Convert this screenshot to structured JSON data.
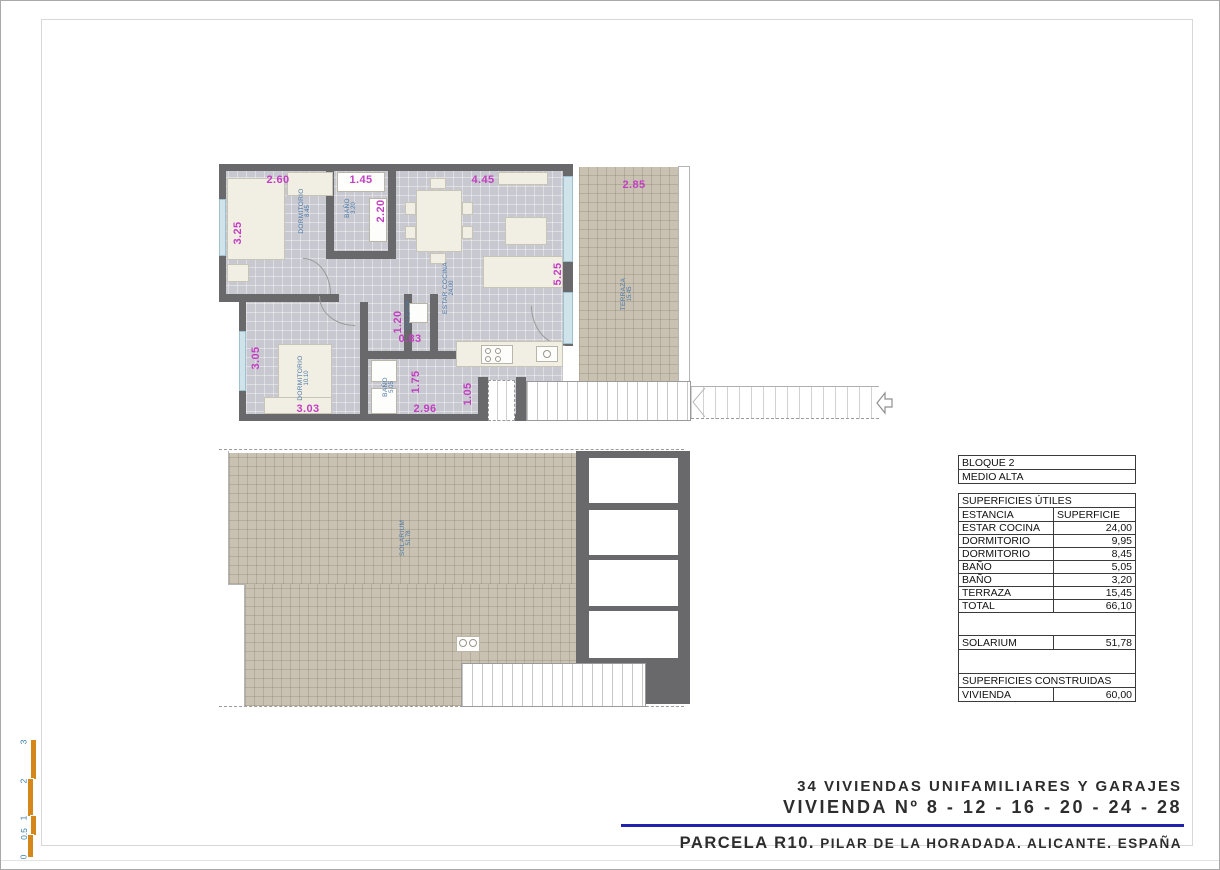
{
  "title_block": {
    "line1": "34 VIVIENDAS UNIFAMILIARES Y GARAJES",
    "line2": "VIVIENDA Nº 8 - 12 - 16 - 20 - 24 - 28",
    "line3_lead": "PARCELA R10.",
    "line3_rest": " PILAR DE LA HORADADA. ALICANTE. ESPAÑA"
  },
  "table": {
    "block": "BLOQUE 2",
    "level": "MEDIO ALTA",
    "section_utiles": "SUPERFICIES ÚTILES",
    "col_room": "ESTANCIA",
    "col_area": "SUPERFICIE",
    "rows": [
      {
        "room": "ESTAR COCINA",
        "area": "24,00"
      },
      {
        "room": "DORMITORIO",
        "area": "9,95"
      },
      {
        "room": "DORMITORIO",
        "area": "8,45"
      },
      {
        "room": "BAÑO",
        "area": "5,05"
      },
      {
        "room": "BAÑO",
        "area": "3,20"
      },
      {
        "room": "TERRAZA",
        "area": "15,45"
      },
      {
        "room": "TOTAL",
        "area": "66,10"
      }
    ],
    "solarium": {
      "room": "SOLARIUM",
      "area": "51,78"
    },
    "section_construidas": "SUPERFICIES CONSTRUIDAS",
    "vivienda": {
      "room": "VIVIENDA",
      "area": "60,00"
    }
  },
  "plan_upper": {
    "rooms": [
      {
        "name": "DORMITORIO",
        "area": "8.45",
        "x": 304,
        "y": 210
      },
      {
        "name": "BAÑO",
        "area": "3.20",
        "x": 350,
        "y": 207
      },
      {
        "name": "ESTAR COCINA",
        "area": "24.00",
        "x": 448,
        "y": 287
      },
      {
        "name": "TERRAZA",
        "area": "15.45",
        "x": 626,
        "y": 293
      },
      {
        "name": "GALERIA",
        "area": "",
        "x": 407,
        "y": 314
      },
      {
        "name": "DORMITORIO",
        "area": "10.10",
        "x": 303,
        "y": 377
      },
      {
        "name": "BAÑO",
        "area": "5.05",
        "x": 388,
        "y": 386
      }
    ],
    "dimensions": [
      {
        "text": "2.60",
        "x": 277,
        "y": 179,
        "rot": 0
      },
      {
        "text": "1.45",
        "x": 360,
        "y": 179,
        "rot": 0
      },
      {
        "text": "4.45",
        "x": 482,
        "y": 179,
        "rot": 0
      },
      {
        "text": "2.85",
        "x": 633,
        "y": 184,
        "rot": 0
      },
      {
        "text": "3.25",
        "x": 237,
        "y": 232,
        "rot": 1
      },
      {
        "text": "2.20",
        "x": 380,
        "y": 210,
        "rot": 1
      },
      {
        "text": "5.25",
        "x": 557,
        "y": 273,
        "rot": 1
      },
      {
        "text": "1.20",
        "x": 397,
        "y": 321,
        "rot": 1
      },
      {
        "text": "0.83",
        "x": 409,
        "y": 338,
        "rot": 0
      },
      {
        "text": "3.05",
        "x": 255,
        "y": 357,
        "rot": 1
      },
      {
        "text": "1.75",
        "x": 415,
        "y": 381,
        "rot": 1
      },
      {
        "text": "1.05",
        "x": 467,
        "y": 393,
        "rot": 1
      },
      {
        "text": "3.03",
        "x": 307,
        "y": 408,
        "rot": 0
      },
      {
        "text": "2.96",
        "x": 424,
        "y": 408,
        "rot": 0
      }
    ]
  },
  "plan_lower": {
    "rooms": [
      {
        "name": "SOLARIUM",
        "area": "51.78",
        "x": 405,
        "y": 537
      }
    ]
  },
  "scale_bar": {
    "labels": [
      {
        "text": "3",
        "x": 20,
        "y": 736
      },
      {
        "text": "2",
        "x": 20,
        "y": 775
      },
      {
        "text": "1",
        "x": 20,
        "y": 812
      },
      {
        "text": "0.5",
        "x": 17,
        "y": 828
      },
      {
        "text": "0",
        "x": 20,
        "y": 851
      }
    ]
  },
  "colors": {
    "dimension": "#c23fc2",
    "room_label": "#4a78a8",
    "wall": "#69696b",
    "floor": "#c8c8d0",
    "tile": "#c9c2b2",
    "accent_line": "#2222b2",
    "scale_bar": "#d6871a"
  }
}
